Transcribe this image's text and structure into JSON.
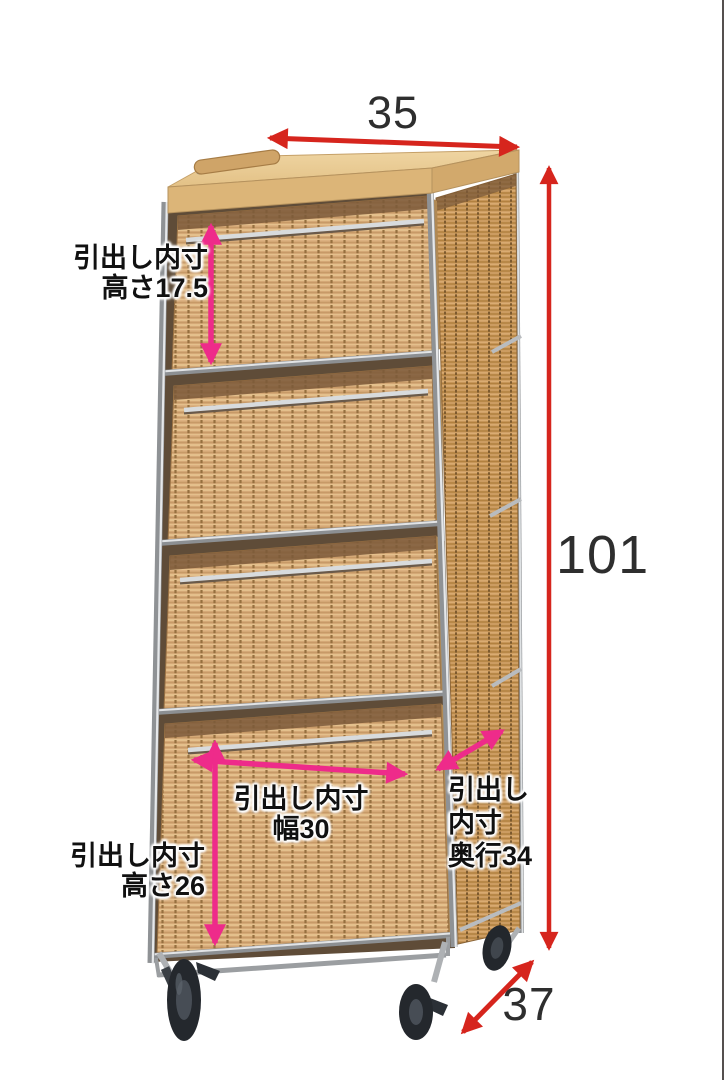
{
  "colors": {
    "red_arrow": "#d6251d",
    "pink_arrow": "#ee2b8a",
    "number_text": "#2e2e2e",
    "label_text": "#111111",
    "page_bg": "#ffffff",
    "right_border": "#55504f"
  },
  "dimensions": {
    "top_width": "35",
    "total_height": "101",
    "bottom_depth": "37"
  },
  "inner_dimensions": {
    "drawer1_height": {
      "line1": "引出し内寸",
      "line2": "高さ17.5"
    },
    "drawer4_height": {
      "line1": "引出し内寸",
      "line2": "高さ26"
    },
    "drawer_width": {
      "line1": "引出し内寸",
      "line2": "幅30"
    },
    "drawer_depth": {
      "line1": "引出し",
      "line2": "内寸",
      "line3": "奥行34"
    }
  },
  "illustration": {
    "description": "4-drawer wicker basket chest with chrome steel frame, wooden top board, top handle and casters"
  }
}
